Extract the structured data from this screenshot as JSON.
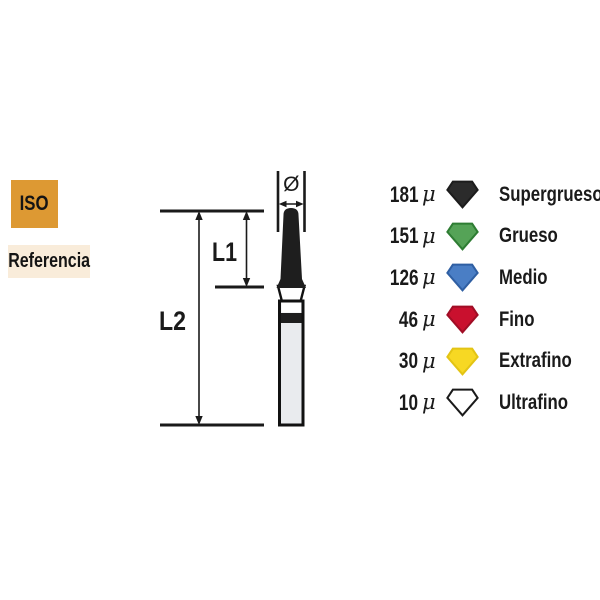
{
  "badges": {
    "iso": {
      "label": "ISO",
      "bg": "#DD9933"
    },
    "referencia": {
      "label": "Referencia",
      "bg": "#F9ECDA"
    }
  },
  "diagram": {
    "diameter_symbol": "Ø",
    "l1_label": "L1",
    "l2_label": "L2",
    "line_color": "#1a1a1a",
    "bur": {
      "tip_color": "#1E1E1E",
      "neck_color": "#FFFFFF",
      "band_color": "#1E1E1E",
      "shank_color": "#E9EBEE",
      "outline_color": "#111111"
    }
  },
  "legend": {
    "rows": [
      {
        "value": "181",
        "unit": "μ",
        "label": "Supergrueso",
        "fill": "#2B2B2B",
        "stroke": "#1C1C1C"
      },
      {
        "value": "151",
        "unit": "μ",
        "label": "Grueso",
        "fill": "#55A357",
        "stroke": "#2E7D33"
      },
      {
        "value": "126",
        "unit": "μ",
        "label": "Medio",
        "fill": "#4A7EC5",
        "stroke": "#2F5FA3"
      },
      {
        "value": "46",
        "unit": "μ",
        "label": "Fino",
        "fill": "#C9102E",
        "stroke": "#A00D25"
      },
      {
        "value": "30",
        "unit": "μ",
        "label": "Extrafino",
        "fill": "#F7D823",
        "stroke": "#E3C414"
      },
      {
        "value": "10",
        "unit": "μ",
        "label": "Ultrafino",
        "fill": "#FFFFFF",
        "stroke": "#1A1A1A"
      }
    ]
  }
}
